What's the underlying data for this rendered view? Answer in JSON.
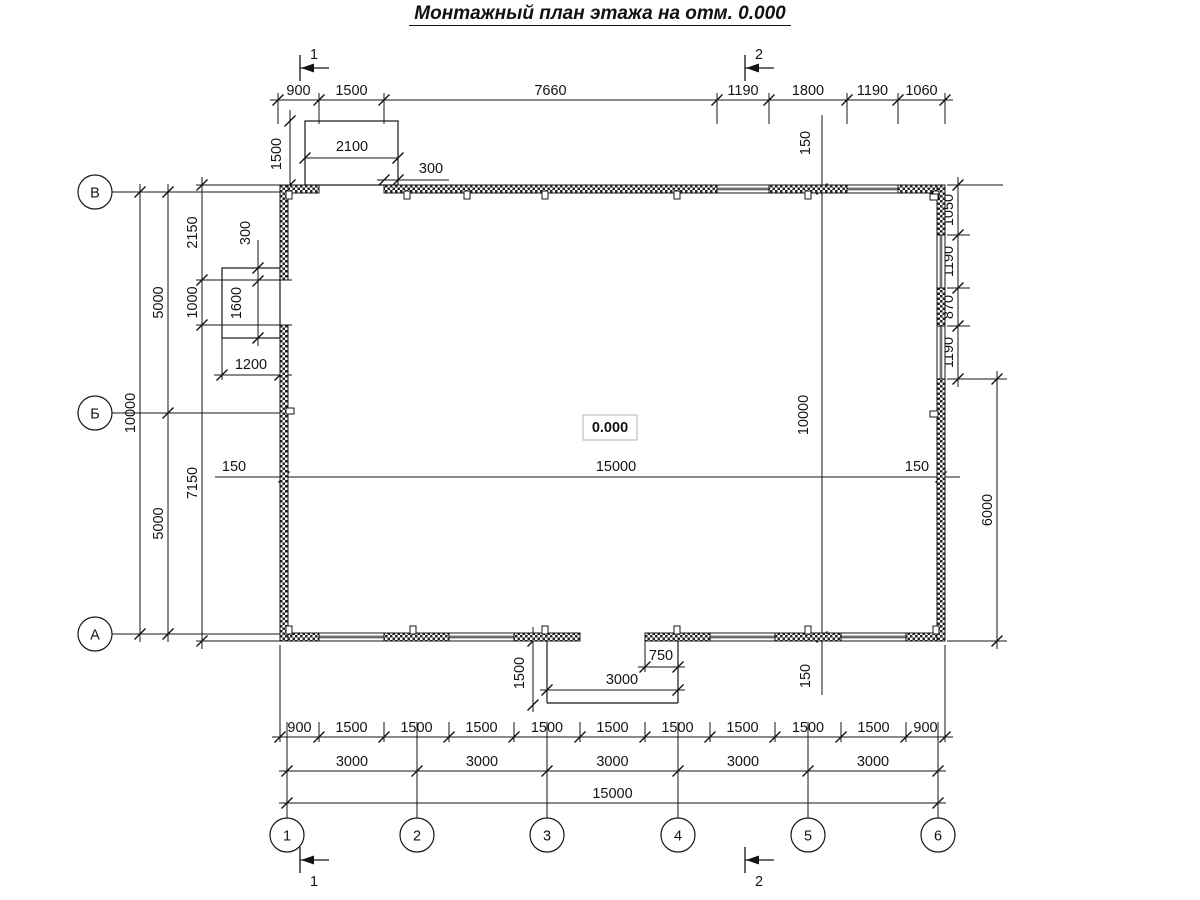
{
  "title": "Монтажный план этажа на отм. 0.000",
  "elevation_mark": "0.000",
  "axes": {
    "rows": [
      "В",
      "Б",
      "А"
    ],
    "cols": [
      "1",
      "2",
      "3",
      "4",
      "5",
      "6"
    ]
  },
  "sections": {
    "top": [
      "1",
      "2"
    ],
    "bottom": [
      "1",
      "2"
    ]
  },
  "dims": {
    "top_row": [
      "900",
      "1500",
      "7660",
      "1190",
      "1800",
      "1190",
      "1060"
    ],
    "top_porch_height": "1500",
    "top_porch_width": "2100",
    "top_porch_offset": "300",
    "left_total": "10000",
    "left_halves": [
      "5000",
      "5000"
    ],
    "left_inner": [
      "2150",
      "1000",
      "7150"
    ],
    "left_box_offset": "300",
    "left_box_height": "1600",
    "left_box_width": "1200",
    "mid_line": [
      "150",
      "15000",
      "150"
    ],
    "interior_line": [
      "150",
      "10000",
      "150"
    ],
    "right_inner": [
      "1050",
      "1190",
      "870",
      "1190"
    ],
    "right_outer": "6000",
    "porch_depth": "1500",
    "porch_width": "3000",
    "porch_offset": "750",
    "bottom_row1": [
      "900",
      "1500",
      "1500",
      "1500",
      "1500",
      "1500",
      "1500",
      "1500",
      "1500",
      "1500",
      "900"
    ],
    "bottom_row2": [
      "3000",
      "3000",
      "3000",
      "3000",
      "3000"
    ],
    "bottom_row3": "15000"
  }
}
